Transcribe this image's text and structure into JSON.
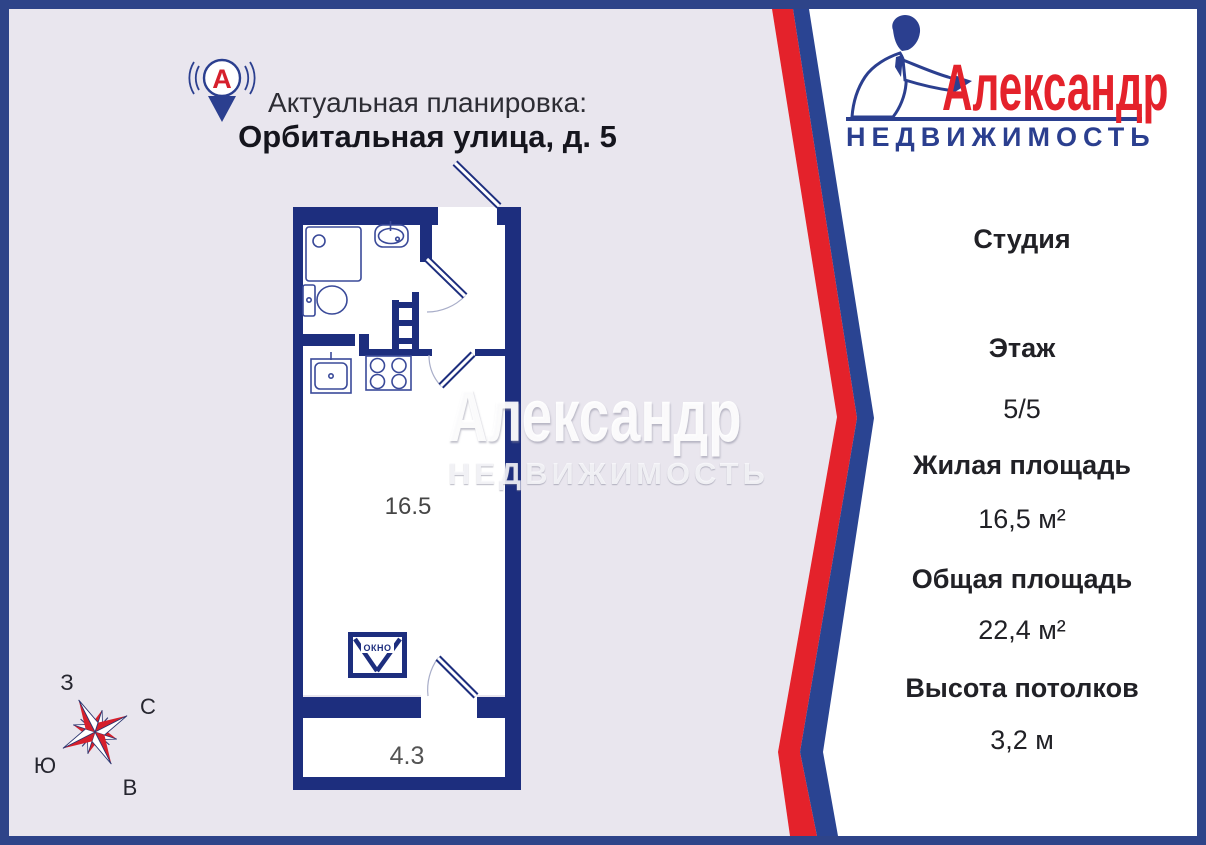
{
  "header": {
    "subtitle": "Актуальная планировка:",
    "address": "Орбитальная улица, д. 5"
  },
  "brand": {
    "name": "Александр",
    "tagline": "НЕДВИЖИМОСТЬ",
    "pin_letter": "А"
  },
  "watermark": {
    "name": "Александр",
    "tagline": "НЕДВИЖИМОСТЬ"
  },
  "plan": {
    "room_area": "16.5",
    "balcony_area": "4.3",
    "window_label": "окно"
  },
  "compass": {
    "west": "З",
    "north": "С",
    "south": "Ю",
    "east": "В"
  },
  "info": {
    "type": "Студия",
    "rows": [
      {
        "label": "Этаж",
        "value": "5/5"
      },
      {
        "label": "Жилая площадь",
        "value": "16,5 м²"
      },
      {
        "label": "Общая площадь",
        "value": "22,4 м²"
      },
      {
        "label": "Высота потолков",
        "value": "3,2 м"
      }
    ]
  },
  "colors": {
    "frame_navy": "#2e4489",
    "wall_navy": "#1d2e7e",
    "brand_red": "#e4222b",
    "brand_blue": "#2b3f8f",
    "stripe_red": "#e4222b",
    "stripe_blue": "#2a4492",
    "left_background": "#e9e6ee"
  }
}
